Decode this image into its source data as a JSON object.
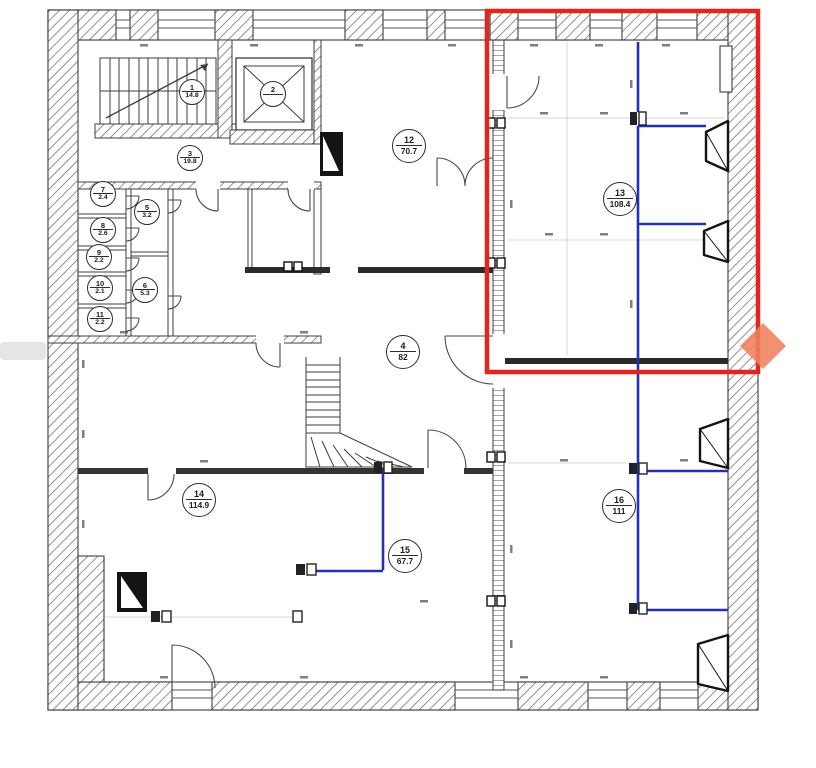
{
  "plan": {
    "rooms": [
      {
        "number": "1",
        "area": "14.8"
      },
      {
        "number": "2",
        "area": ""
      },
      {
        "number": "3",
        "area": "19.8"
      },
      {
        "number": "4",
        "area": "82"
      },
      {
        "number": "5",
        "area": "3.2"
      },
      {
        "number": "6",
        "area": "5.3"
      },
      {
        "number": "7",
        "area": "2.4"
      },
      {
        "number": "8",
        "area": "2.6"
      },
      {
        "number": "9",
        "area": "2.2"
      },
      {
        "number": "10",
        "area": "2.1"
      },
      {
        "number": "11",
        "area": "2.2"
      },
      {
        "number": "12",
        "area": "70.7"
      },
      {
        "number": "13",
        "area": "108.4"
      },
      {
        "number": "14",
        "area": "114.9"
      },
      {
        "number": "15",
        "area": "67.7"
      },
      {
        "number": "16",
        "area": "111"
      }
    ],
    "highlight": {
      "color": "#e2261d"
    },
    "partitions": {
      "color": "#2531b4"
    },
    "watermark": {
      "color": "#f0815d"
    },
    "ink": {
      "color": "#3c3c3c"
    }
  }
}
